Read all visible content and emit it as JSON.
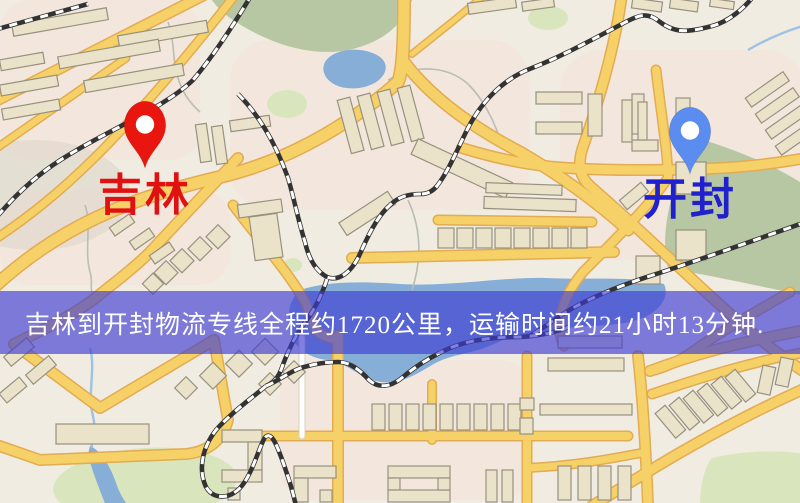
{
  "image": {
    "width": 800,
    "height": 503,
    "description": "街道地图，显示吉林与开封两个位置标记及物流专线信息横幅"
  },
  "banner": {
    "text": "吉林到开封物流专线全程约1720公里，运输时间约21小时13分钟.",
    "text_color": "#ffffff",
    "bg_color": "rgba(62,60,210,0.65)"
  },
  "route": {
    "origin": "吉林",
    "destination": "开封",
    "distance_text": "约1720公里",
    "duration_text": "约21小时13分钟"
  },
  "markers": [
    {
      "label": "吉林",
      "pin_color": "#e9150f",
      "label_color": "#df1111",
      "x": 145,
      "tip_y": 168,
      "label_top": 174
    },
    {
      "label": "开封",
      "pin_color": "#5b8cf0",
      "label_color": "#2020cc",
      "x": 690,
      "tip_y": 174,
      "label_top": 178
    }
  ],
  "colors": {
    "map_bg": "#f0ece1",
    "road_fill": "#f6d168",
    "road_casing": "#e3ab52",
    "water": "#86aed6",
    "park": "#b8c7a3",
    "park_light": "#d9e6bd",
    "building": "#eae2c9",
    "building_stroke": "#97917f",
    "railway": "#333333",
    "pink_zone": "#f6e3da",
    "minor_road": "#ffffff",
    "stream": "#b9bdb2"
  }
}
